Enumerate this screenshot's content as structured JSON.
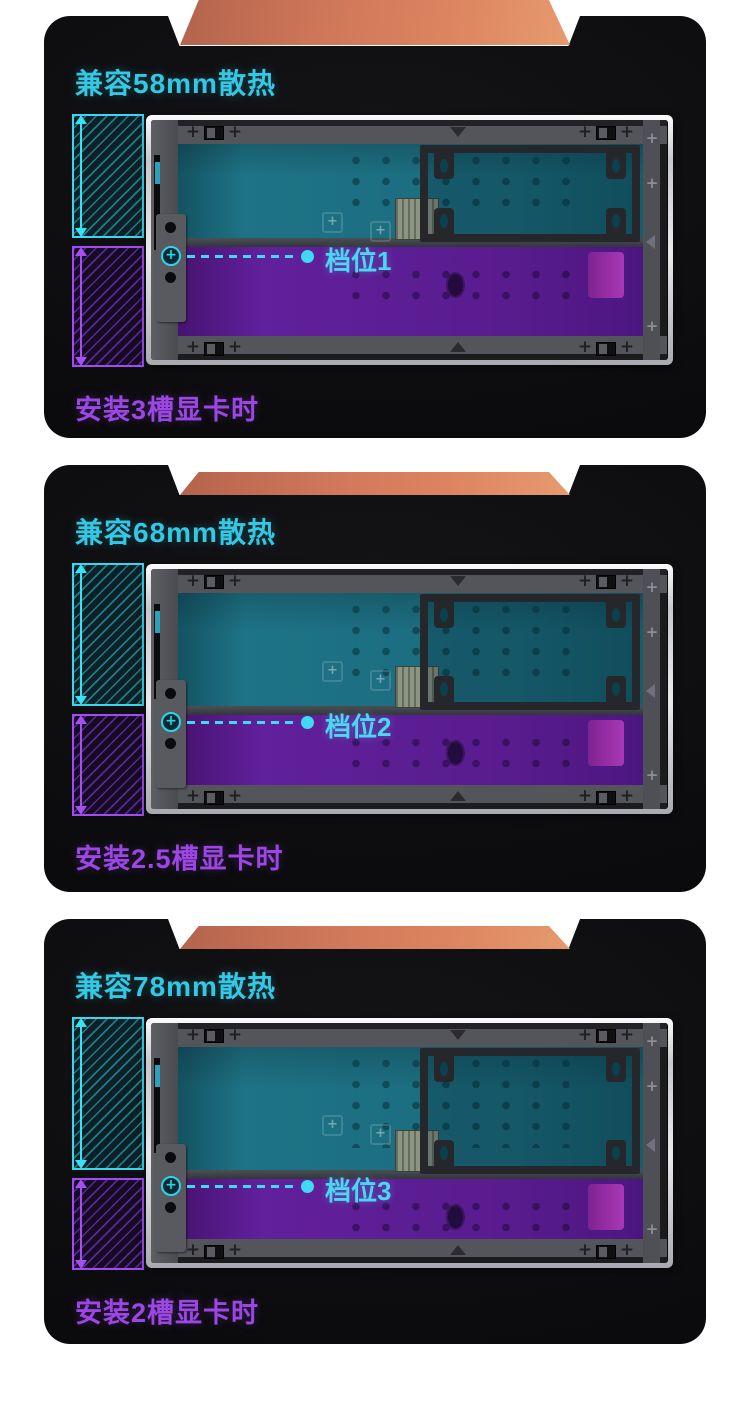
{
  "page": {
    "background_color": "#ffffff",
    "card_background_color": "#0d0d0f",
    "language": "zh-CN"
  },
  "accent_colors": {
    "cyan_text": "#33c9e5",
    "purple_text": "#9c46e6",
    "cyan_arrow": "#38e2f5",
    "purple_arrow": "#a44ff0",
    "orange_case_top": "#d87e5e",
    "teal_region": "#1d7184",
    "purple_region": "#5d1e93"
  },
  "panels": [
    {
      "title": "兼容58mm散热",
      "cooler_clearance": "58mm",
      "gear_label": "档位1",
      "bottom_label": "安装3槽显卡时",
      "gpu_slot_width": "3槽",
      "screw_plus": "+"
    },
    {
      "title": "兼容68mm散热",
      "cooler_clearance": "68mm",
      "gear_label": "档位2",
      "bottom_label": "安装2.5槽显卡时",
      "gpu_slot_width": "2.5槽",
      "screw_plus": "+"
    },
    {
      "title": "兼容78mm散热",
      "cooler_clearance": "78mm",
      "gear_label": "档位3",
      "bottom_label": "安装2槽显卡时",
      "gpu_slot_width": "2槽",
      "screw_plus": "+"
    }
  ]
}
